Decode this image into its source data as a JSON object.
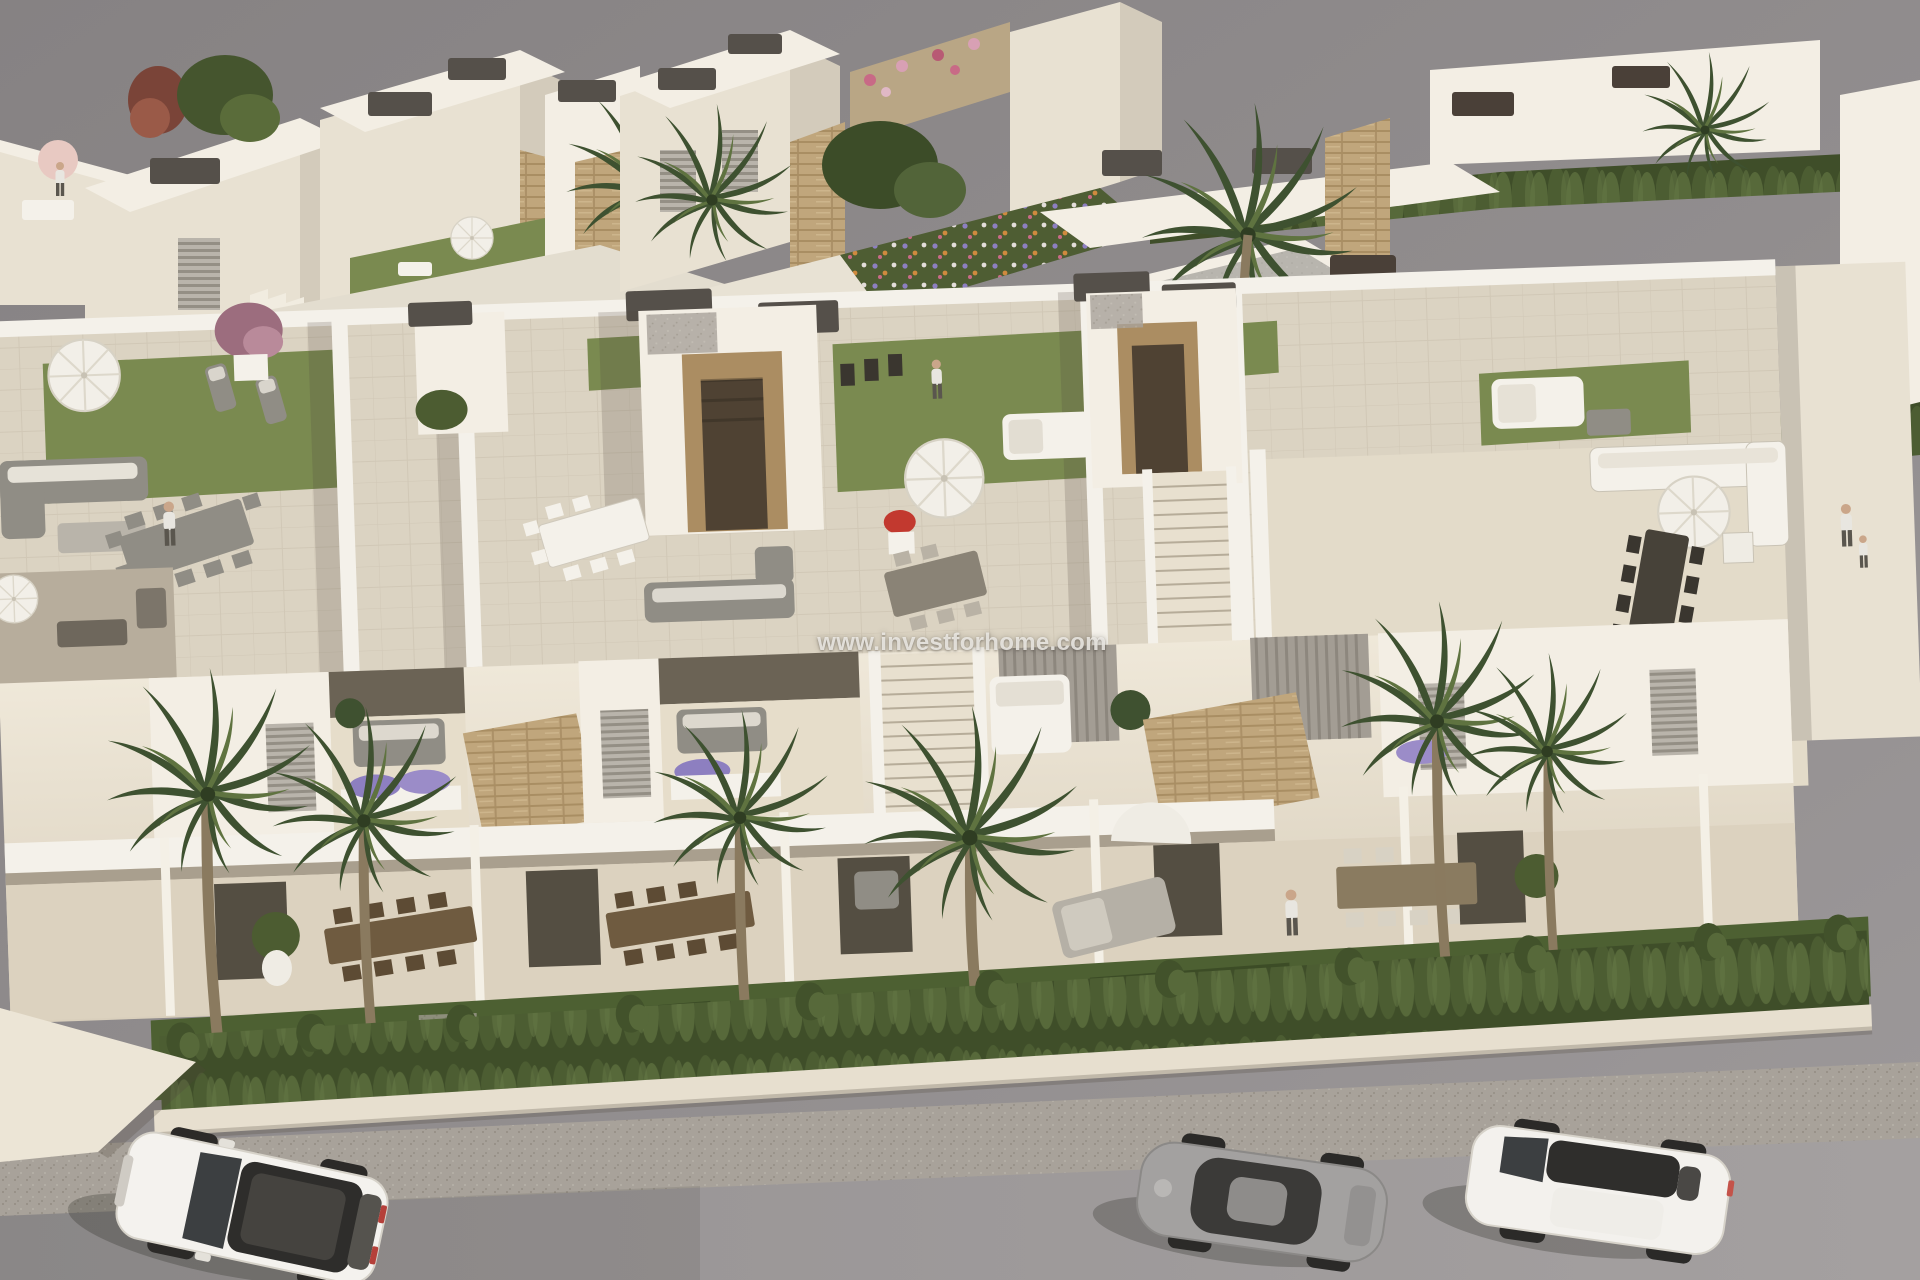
{
  "meta": {
    "description": "Aerial 3D architectural rendering of a modern white townhouse development with rooftop terraces, front gardens, a trimmed hedge and a street with three parked cars",
    "render_style": "computer-generated real-estate visualization, overcast gray backdrop, warm afternoon light from the right"
  },
  "watermark": {
    "text": "www.investforhome.com",
    "color": "#eeece7",
    "position": "center of image"
  },
  "palette": {
    "sky_gray": "#8c8889",
    "building_white": "#f3eee4",
    "building_cream": "#e8e1d2",
    "building_shadow": "#b3aa99",
    "stone_cladding": "#c0a67c",
    "wood_door": "#ab8d62",
    "roof_cap_dark": "#55504a",
    "roof_gravel_gray": "#b8b5ae",
    "terrace_tile": "#dbd3c2",
    "rooftop_lawn_green": "#7a8a50",
    "garden_lawn_green": "#4d6032",
    "hedge_green": "#47572e",
    "palm_green": "#3e5130",
    "road_gray": "#9d999a",
    "sidewalk_gray": "#a8a29a",
    "umbrella_white": "#f2efe8",
    "flower_purple": "#8d7fc0",
    "flower_pink": "#d08ba4",
    "flower_red": "#c2392f"
  },
  "scene": {
    "background": {
      "label": "plain gray sky backdrop"
    },
    "back_rows": {
      "left_cluster": "white villas with roof terraces, external staircases, parasols and palm trees",
      "center_cluster": "white townhouses with stone-clad cores, rubble garden wall and colorful flower beds",
      "right_cluster": "receding row of white villas with gray gravel flat roofs, dark roof caps, cypress hedges, tall fan palm and pink bougainvillea"
    },
    "mid_band": {
      "label": "rooftop solarium terraces of the front townhouse row",
      "features": [
        "artificial lawn patches",
        "white parasols",
        "gray sun loungers",
        "outdoor lounge sofas",
        "long dining tables with chairs",
        "stair-access towers with wooden doors",
        "dark gray roof cap boxes",
        "white pebble gravel strips",
        "woman walking on left terrace",
        "white double daybed",
        "couple standing at right railing"
      ]
    },
    "facade_band": {
      "label": "first-floor balconies and covered ground-floor terraces",
      "features": [
        "stacked-stone privacy walls",
        "gray balcony sofas with white cushions",
        "lavender planter boxes",
        "white louvered shutters",
        "gray slatted privacy screens",
        "external staircases",
        "dark wood dining sets",
        "double sun bed with parasol",
        "potted shrubs in white vases",
        "man standing on terrace"
      ]
    },
    "garden_band": {
      "label": "front gardens along the street",
      "features": [
        "dark green lawn",
        "tall fan palms",
        "continuous trimmed cypress hedge row",
        "low white boundary wall"
      ]
    },
    "street": {
      "label": "gray asphalt street with speckled sidewalk strip and white corner wall",
      "cars": [
        {
          "label": "white SUV with dark panoramic glass roof",
          "position": "bottom left",
          "heading": "angled toward lower-left"
        },
        {
          "label": "gray sports coupe",
          "position": "bottom center-right",
          "heading": "angled toward lower-left"
        },
        {
          "label": "white sedan with dark glass roof strip",
          "position": "bottom right",
          "heading": "angled toward lower-left"
        }
      ]
    }
  }
}
